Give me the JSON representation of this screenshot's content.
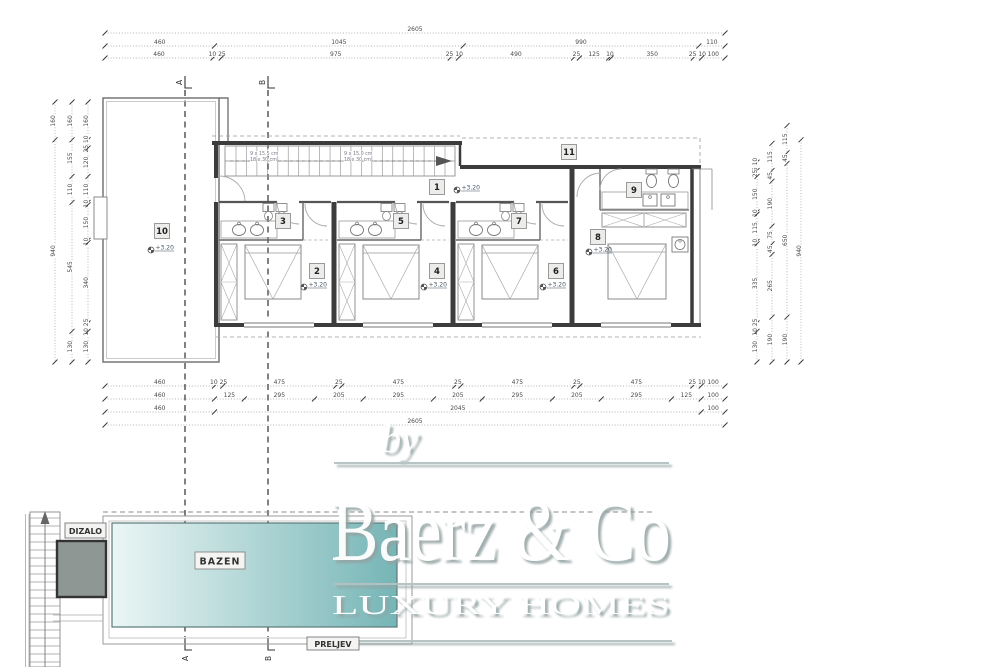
{
  "watermark": {
    "by": "by",
    "brand": "Baerz & Co",
    "tagline": "LUXURY HOMES"
  },
  "labels": {
    "pool": "BAZEN",
    "elevator": "DIZALO",
    "overflow": "PRELJEV"
  },
  "sections": {
    "a": "A",
    "b": "B"
  },
  "stairs": {
    "flight1_line1": "9 x 15.5 cm",
    "flight1_line2": "18 x 30 cm",
    "flight2_line1": "9 x 15.0 cm",
    "flight2_line2": "18 x 30 cm"
  },
  "level_value": "+3.20",
  "rooms": [
    {
      "id": "1",
      "level": "+3.20"
    },
    {
      "id": "2",
      "level": "+3.20"
    },
    {
      "id": "3"
    },
    {
      "id": "4",
      "level": "+3.20"
    },
    {
      "id": "5"
    },
    {
      "id": "6",
      "level": "+3.20"
    },
    {
      "id": "7"
    },
    {
      "id": "8",
      "level": "+3.20"
    },
    {
      "id": "9"
    },
    {
      "id": "10",
      "level": "+3.20"
    },
    {
      "id": "11"
    }
  ],
  "dimensions": {
    "top": [
      [
        "2605"
      ],
      [
        "460",
        "1045",
        "990",
        "110"
      ],
      [
        "460",
        "10 25",
        "975",
        "25 10",
        "490",
        "25",
        "125",
        "10",
        "350",
        "25 10",
        "100"
      ]
    ],
    "bottom": [
      [
        "460",
        "10 25",
        "475",
        "25",
        "475",
        "25",
        "475",
        "25",
        "475",
        "25 10",
        "100"
      ],
      [
        "460",
        "125",
        "295",
        "205",
        "295",
        "205",
        "295",
        "205",
        "295",
        "125",
        "100"
      ],
      [
        "460",
        "2045",
        "100"
      ],
      [
        "2605"
      ]
    ],
    "left": [
      [
        "160",
        "940"
      ],
      [
        "160",
        "155",
        "110",
        "545",
        "130"
      ],
      [
        "160",
        "25 10",
        "120",
        "110",
        "10",
        "150",
        "10",
        "340",
        "10 25",
        "130"
      ]
    ],
    "right": [
      [
        "25 10",
        "25",
        "150",
        "10",
        "115",
        "10",
        "335",
        "10 25",
        "130"
      ],
      [
        "115",
        "45",
        "190",
        "75",
        "45",
        "265",
        "190"
      ],
      [
        "115",
        "45",
        "650",
        "190"
      ],
      [
        "940"
      ]
    ]
  },
  "colors": {
    "pool_light": "#ebf6f5",
    "pool_dark": "#76b5b6",
    "elevator_fill": "#8f9794",
    "wall": "#3c3c3c",
    "dim_text": "#4a4a4a",
    "watermark_shadow": "#94a2a2"
  }
}
